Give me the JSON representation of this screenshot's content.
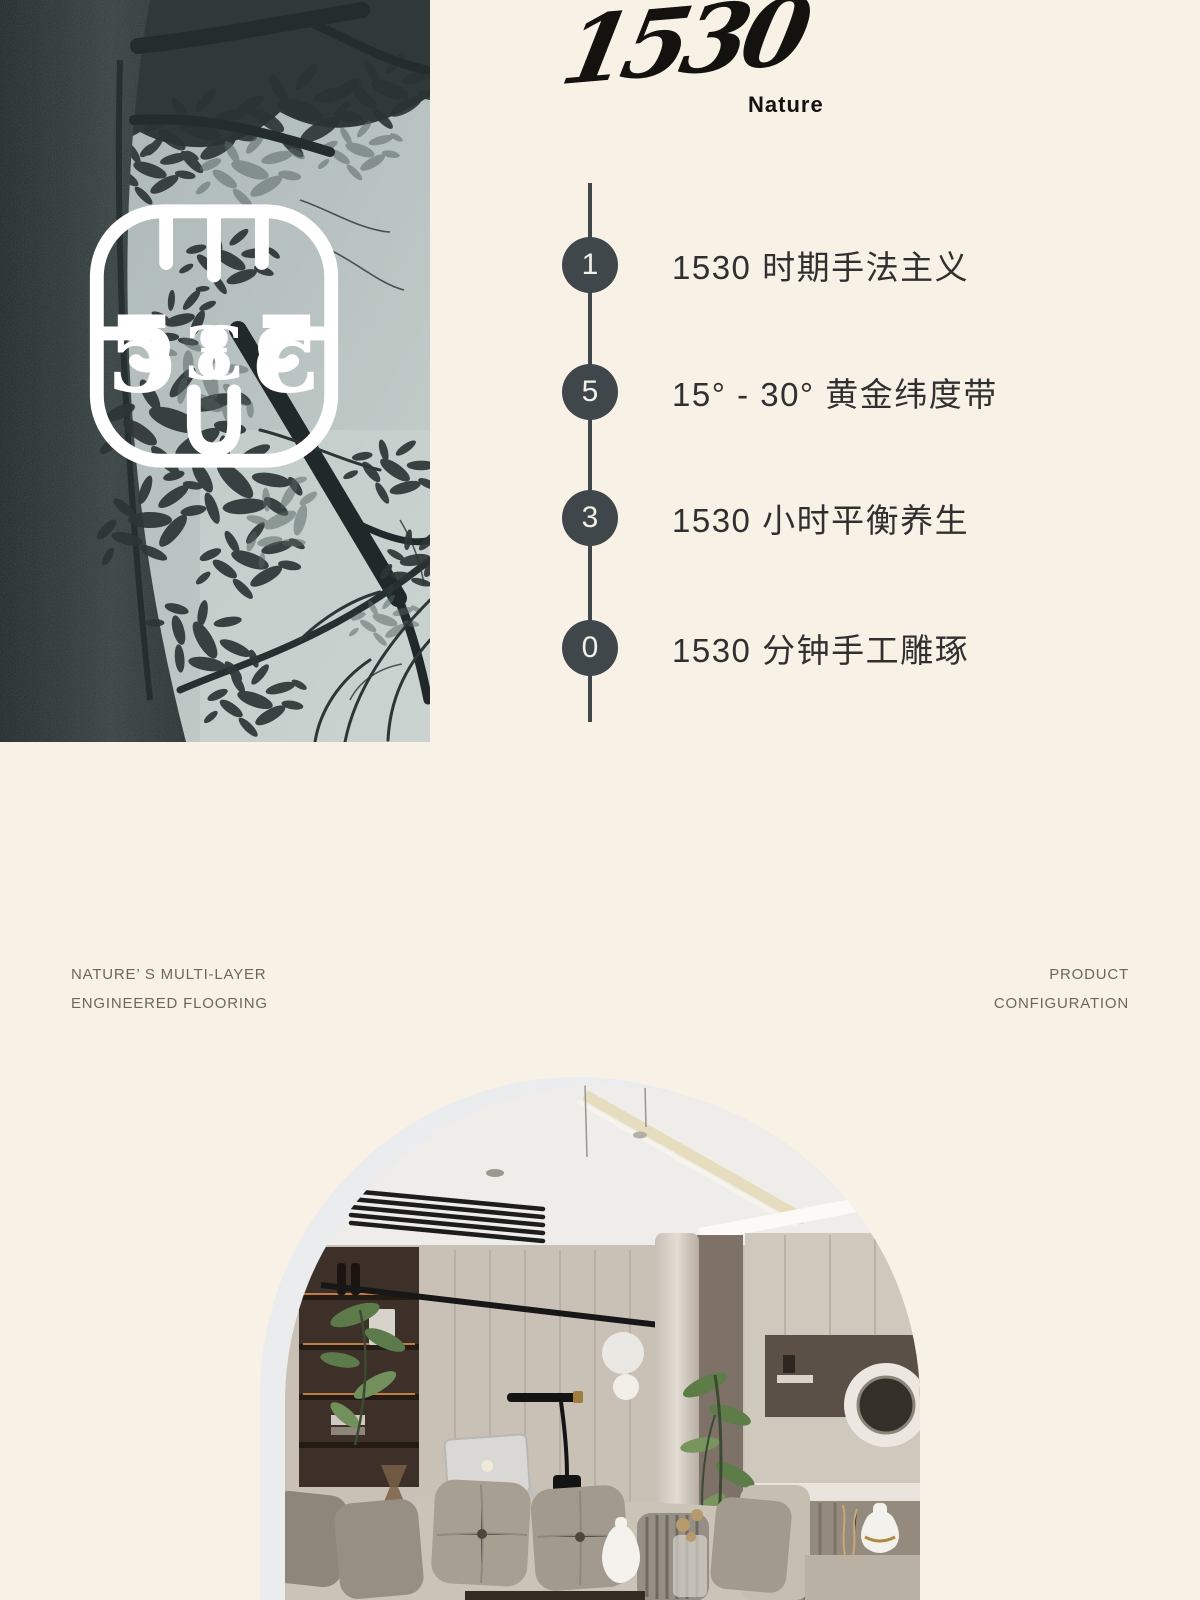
{
  "page": {
    "background": "#f8f1e6"
  },
  "brand": {
    "wordmark": "1530",
    "subtitle": "Nature"
  },
  "timeline": {
    "accent_color": "#3f474b",
    "items": [
      {
        "number": "1",
        "label": "1530 时期手法主义"
      },
      {
        "number": "5",
        "label": "15° - 30° 黄金纬度带"
      },
      {
        "number": "3",
        "label": "1530 小时平衡养生"
      },
      {
        "number": "0",
        "label": "1530 分钟手工雕琢"
      }
    ]
  },
  "captions": {
    "left_line1": "NATURE’ S MULTI-LAYER",
    "left_line2": "ENGINEERED FLOORING",
    "right_line1": "PRODUCT",
    "right_line2": "CONFIGURATION"
  },
  "icons": {
    "emblem": "ornamental-1530-monogram"
  },
  "colors": {
    "background": "#f8f1e6",
    "timeline_circle": "#3f474b",
    "timeline_text": "#303030",
    "caption_gray": "#6e675e",
    "logo_black": "#14120f",
    "tree_sky": "#b8c3c1",
    "tree_dark": "#2b3334",
    "arch_border": "#ebeced",
    "interior_wall": "#c9c1b6"
  }
}
